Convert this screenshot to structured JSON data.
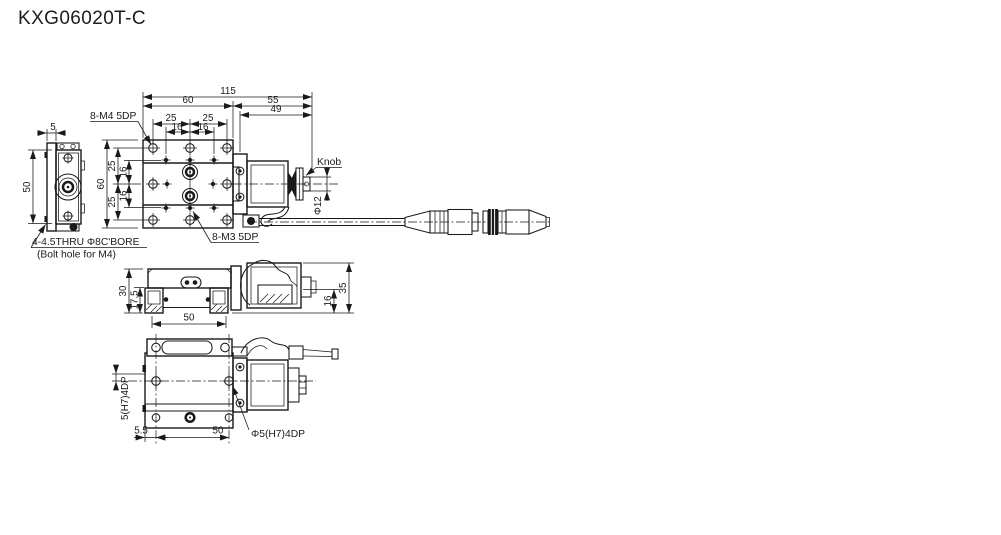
{
  "title": "KXG06020T-C",
  "views": {
    "top": {
      "dim_overall": "115",
      "dim_stage_w": "60",
      "dim_motor_w": "55",
      "dim_49": "49",
      "dim_25a": "25",
      "dim_25b": "25",
      "dim_16a": "16",
      "dim_16b": "16",
      "dim_h60": "60",
      "dim_v25a": "25",
      "dim_v25b": "25",
      "dim_v16a": "16",
      "dim_v16b": "16",
      "label_m4_holes": "8-M4 5DP",
      "label_m3_holes": "8-M3 5DP",
      "label_knob": "Knob",
      "label_knob_dia": "Φ12"
    },
    "end": {
      "dim_5": "5",
      "dim_50": "50",
      "note_line1": "4-4.5THRU Φ8C'BORE",
      "note_line2": "(Bolt hole for M4)"
    },
    "front": {
      "dim_30": "30",
      "dim_17_5": "17.5",
      "dim_50": "50",
      "dim_35": "35",
      "dim_16": "16"
    },
    "bottom": {
      "dim_pin": "5(H7)4DP",
      "dim_5_5": "5.5",
      "dim_50": "50",
      "label_pin_hole": "Φ5(H7)4DP"
    }
  }
}
